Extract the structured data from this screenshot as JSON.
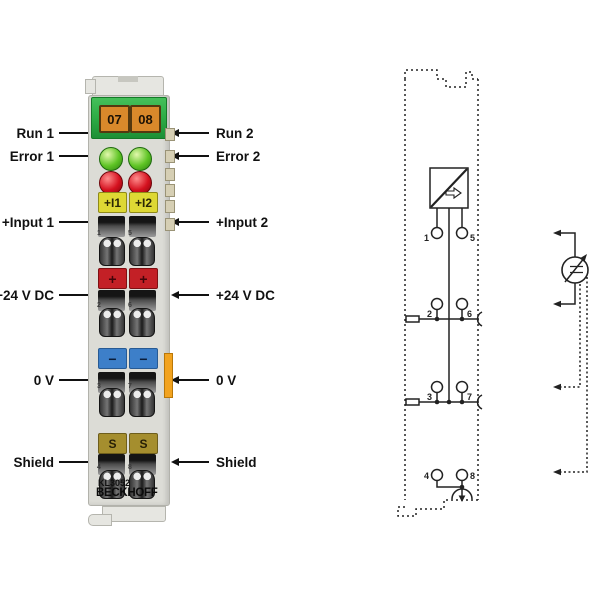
{
  "terminal": {
    "address_labels": [
      "07",
      "08"
    ],
    "channel_labels": [
      "+I1",
      "+I2"
    ],
    "polarity_plus": [
      "+",
      "+"
    ],
    "polarity_minus": [
      "−",
      "−"
    ],
    "shield_keys": [
      "S",
      "S"
    ],
    "clamp_numbers": [
      "1",
      "5",
      "2",
      "6",
      "3",
      "7",
      "4",
      "8"
    ],
    "model": "KL3052",
    "brand": "BECKHOFF"
  },
  "labels": {
    "left": [
      "Run 1",
      "Error 1",
      "+Input 1",
      "+24 V DC",
      "0 V",
      "Shield"
    ],
    "right": [
      "Run 2",
      "Error 2",
      "+Input 2",
      "+24 V DC",
      "0 V",
      "Shield"
    ]
  },
  "schematic": {
    "terminal_numbers": [
      "1",
      "5",
      "2",
      "6",
      "3",
      "7",
      "4",
      "8"
    ]
  },
  "colors": {
    "body": "#dcdcd6",
    "clip": "#e6e6e1",
    "green-block": "#2fae47",
    "orange-label": "#d9892b",
    "orange-border": "#54380f",
    "led-green": "#5ec424",
    "led-red": "#d5111f",
    "yellow-label": "#ded834",
    "red-label": "#c32026",
    "blue-label": "#3d7fc9",
    "gold-label": "#a58e2e",
    "side-tab": "#f2a31f",
    "kbus": "#d6cfb4",
    "line": "#111111"
  }
}
